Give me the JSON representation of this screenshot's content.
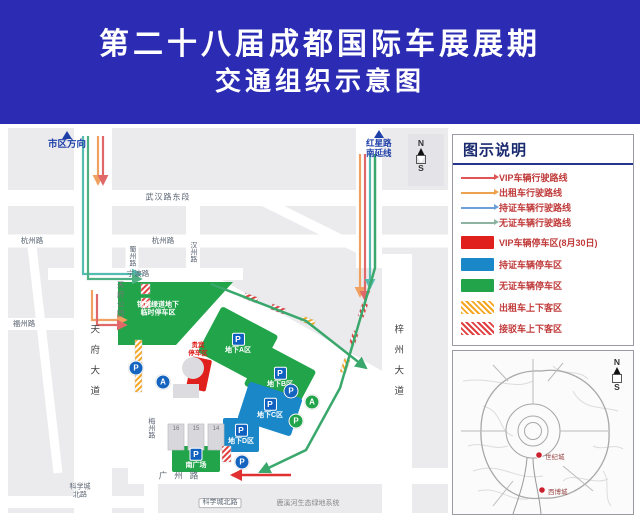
{
  "title": {
    "line1": "第二十八届成都国际车展展期",
    "line2": "交通组织示意图"
  },
  "colors": {
    "banner_blue": "#2b2bb3",
    "direction_blue": "#1d3fa8",
    "green_zone": "#21a44a",
    "blue_zone": "#1a87c8",
    "red_zone": "#e0201c"
  },
  "map": {
    "direction_labels": {
      "city": "市区方向",
      "hongxing_line1": "红星路",
      "hongxing_line2": "南延线"
    },
    "compass": {
      "n": "N",
      "s": "S"
    },
    "road_labels": [
      "武汉路东段",
      "杭州路",
      "杭州路",
      "蜀州路",
      "汉州路",
      "宁波路",
      "福州路",
      "天府大道",
      "梓州大道",
      "梅州路",
      "广州路",
      "科学城北路",
      "科学城北路",
      "鹿溪河生态绿地系统",
      "天府公园"
    ],
    "areas": {
      "greenway": {
        "line1": "锦城绿道地下",
        "line2": "临时停车区"
      },
      "zone_a": "地下A区",
      "zone_b": "地下B区",
      "zone_c": "地下C区",
      "zone_d": "地下D区",
      "south_plaza": "南广场",
      "vip": {
        "line1": "贵宾",
        "line2": "停车区"
      }
    },
    "hall_labels": [
      "16",
      "15",
      "14"
    ],
    "marker_letters": {
      "parking": "P",
      "shuttle": "A"
    }
  },
  "legend": {
    "title": "图示说明",
    "route_items": [
      {
        "label": "VIP车辆行驶路线",
        "color": "#e05555"
      },
      {
        "label": "出租车行驶路线",
        "color": "#eda24f"
      },
      {
        "label": "持证车辆行驶路线",
        "color": "#6d9fd8"
      },
      {
        "label": "无证车辆行驶路线",
        "color": "#8fb3a1"
      }
    ],
    "zone_items": [
      {
        "label": "VIP车辆停车区(8月30日)",
        "color": "#e0201c",
        "hatch": false
      },
      {
        "label": "持证车辆停车区",
        "color": "#1a87c8",
        "hatch": false
      },
      {
        "label": "无证车辆停车区",
        "color": "#21a44a",
        "hatch": false
      },
      {
        "label": "出租车上下客区",
        "color": "#f5a623",
        "hatch": true
      },
      {
        "label": "接驳车上下客区",
        "color": "#e04040",
        "hatch": true
      }
    ]
  },
  "inset": {
    "markers": [
      "世纪城",
      "西博城"
    ],
    "compass": {
      "n": "N",
      "s": "S"
    }
  }
}
